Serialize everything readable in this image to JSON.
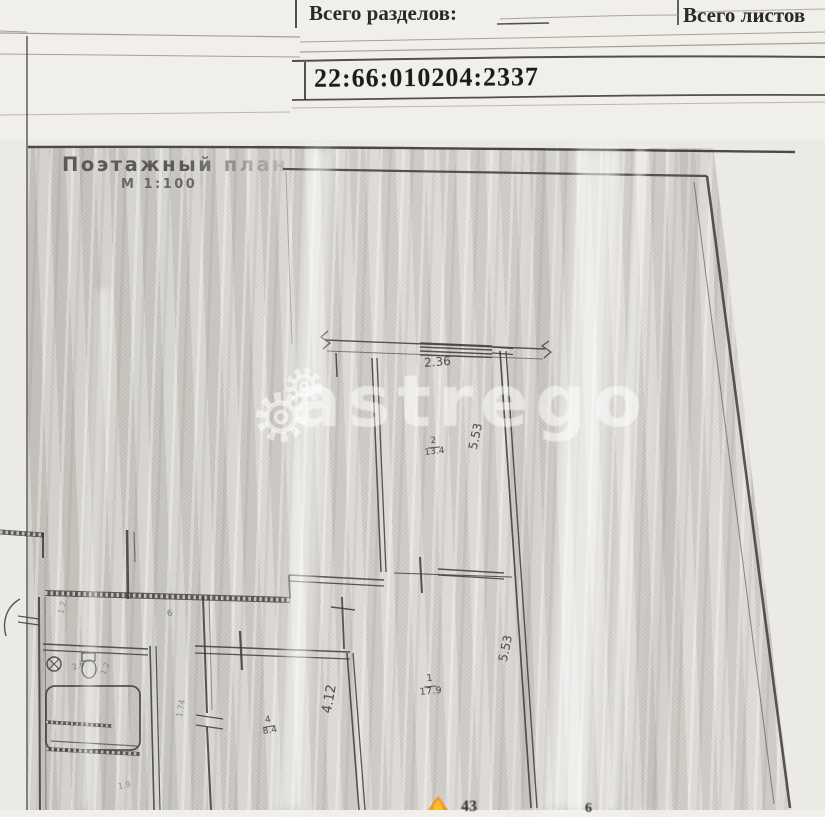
{
  "header": {
    "total_sections_label": "Всего разделов:",
    "total_sheets_label": "Всего листов",
    "cadastral_number": "22:66:010204:2337"
  },
  "plan": {
    "title": "Поэтажный план",
    "scale": "М 1:100",
    "dims": {
      "balcony_width": "2.36",
      "room2_depth": "5.53",
      "room1_depth": "5.53",
      "room4_depth": "4.12"
    },
    "rooms": [
      {
        "number": "2",
        "area": "13.4"
      },
      {
        "number": "1",
        "area": "17.9"
      },
      {
        "number": "4",
        "area": "8.4"
      }
    ],
    "tiny_marks": {
      "wc_number": "6",
      "bath_width": "2.6",
      "bath_depth": "1.2",
      "hall_width": "1.2",
      "kitchen_depth": "1.74",
      "niche": "1.9"
    },
    "cutoff_fragments": {
      "left": "43",
      "right": "6"
    }
  },
  "watermark": {
    "text": "astrego"
  }
}
